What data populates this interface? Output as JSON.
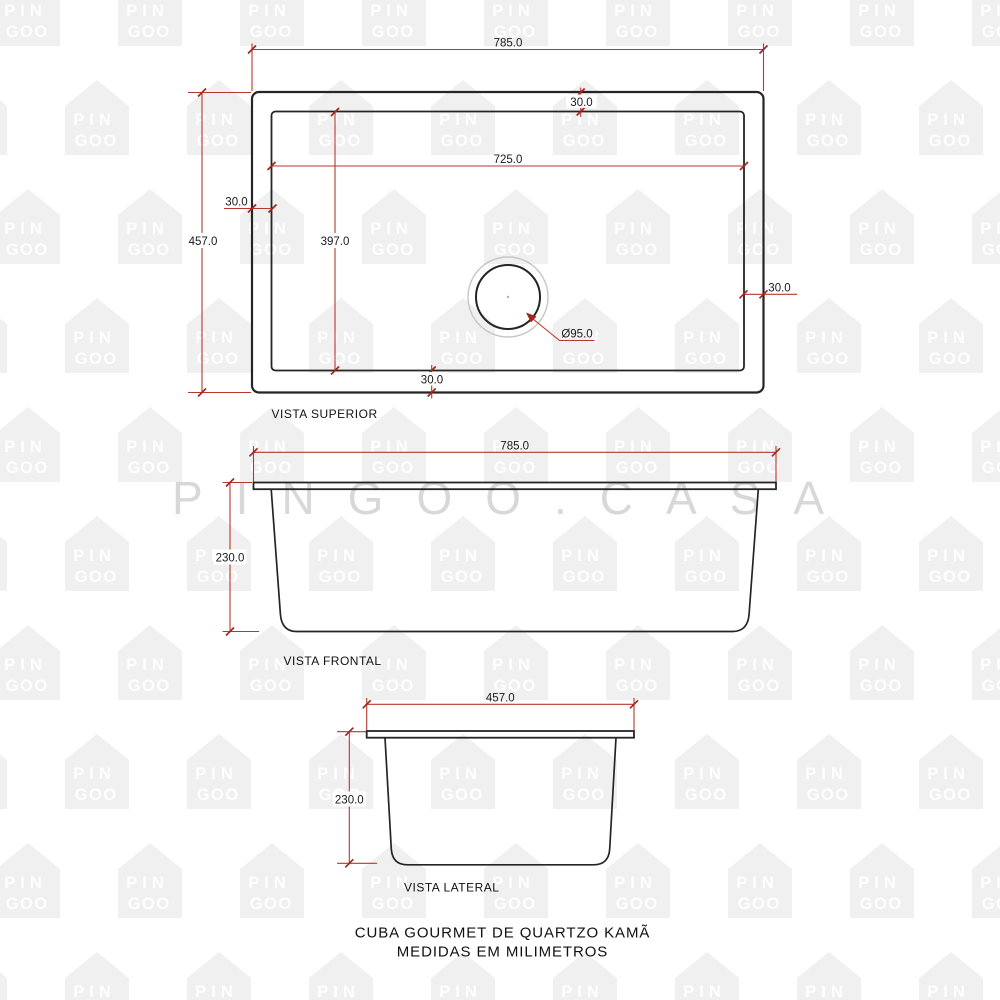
{
  "watermark": {
    "house_line1": "PIN",
    "house_line2": "GOO",
    "brand_text": "PINGOO.CASA"
  },
  "colors": {
    "dimension_line": "#b5392e",
    "dimension_tick": "#a1271c",
    "drawing_line": "#252525",
    "dimension_text": "#1a1a1a",
    "watermark_house": "#f0f0f0",
    "watermark_brand": "#d8d8d8",
    "drain_ring": "#c6c6c6"
  },
  "views": {
    "top": {
      "label": "VISTA SUPERIOR",
      "dim_width": "785.0",
      "dim_inner_width": "725.0",
      "dim_height": "457.0",
      "dim_inner_height": "397.0",
      "dim_offset_left": "30.0",
      "dim_offset_top": "30.0",
      "dim_offset_bottom": "30.0",
      "dim_offset_right": "30.0",
      "dim_drain_diameter": "Ø95.0"
    },
    "front": {
      "label": "VISTA FRONTAL",
      "dim_width": "785.0",
      "dim_height": "230.0"
    },
    "side": {
      "label": "VISTA LATERAL",
      "dim_width": "457.0",
      "dim_height": "230.0"
    }
  },
  "title": {
    "line1": "CUBA GOURMET DE QUARTZO KAMÃ",
    "line2": "MEDIDAS EM MILIMETROS"
  }
}
